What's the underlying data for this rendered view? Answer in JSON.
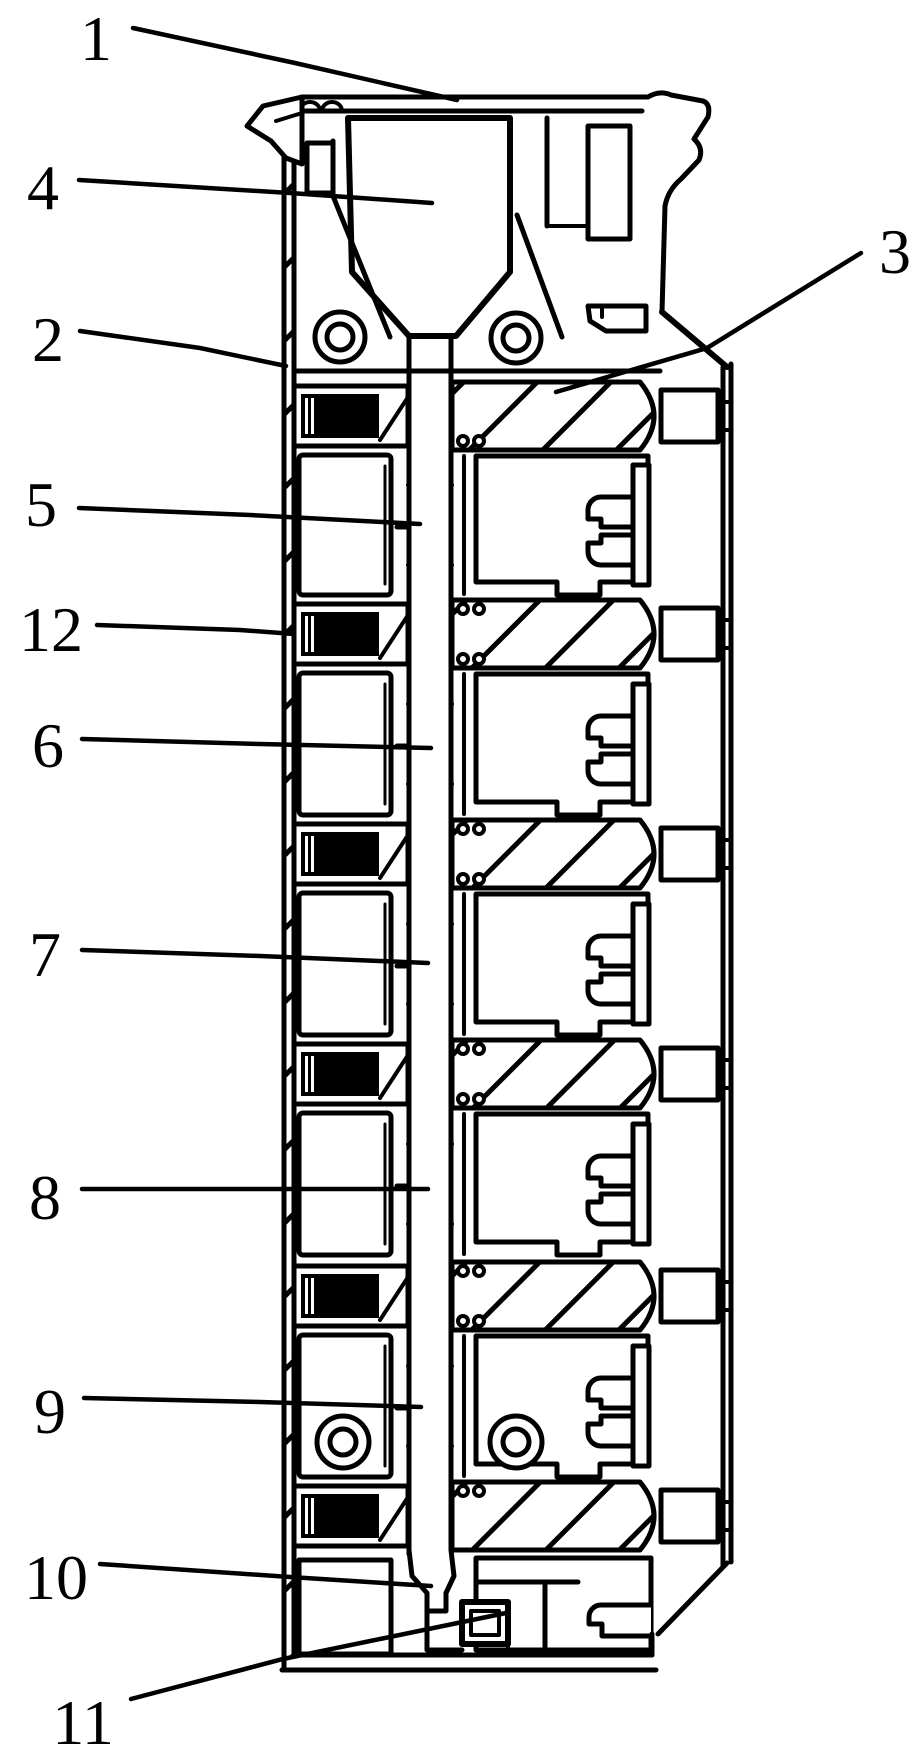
{
  "figure": {
    "description": "patent-style sectional diagram of a vertical multi-chamber connector assembly",
    "colors": {
      "ink": "#000000",
      "paper": "#ffffff"
    }
  },
  "labels": [
    {
      "text": "1",
      "x": 96,
      "y": 38,
      "leader": [
        [
          133,
          28
        ],
        [
          295,
          63
        ],
        [
          457,
          100
        ]
      ]
    },
    {
      "text": "4",
      "x": 43,
      "y": 187,
      "leader": [
        [
          79,
          180
        ],
        [
          290,
          193
        ],
        [
          432,
          203
        ]
      ]
    },
    {
      "text": "2",
      "x": 48,
      "y": 339,
      "leader": [
        [
          80,
          331
        ],
        [
          200,
          348
        ],
        [
          286,
          366
        ]
      ]
    },
    {
      "text": "3",
      "x": 895,
      "y": 251,
      "leader": [
        [
          861,
          253
        ],
        [
          707,
          348
        ],
        [
          556,
          392
        ]
      ]
    },
    {
      "text": "5",
      "x": 41,
      "y": 504,
      "leader": [
        [
          79,
          508
        ],
        [
          250,
          515
        ],
        [
          420,
          524
        ]
      ]
    },
    {
      "text": "12",
      "x": 51,
      "y": 629,
      "leader": [
        [
          97,
          625
        ],
        [
          240,
          630
        ],
        [
          294,
          634
        ]
      ]
    },
    {
      "text": "6",
      "x": 48,
      "y": 745,
      "leader": [
        [
          82,
          739
        ],
        [
          260,
          744
        ],
        [
          431,
          748
        ]
      ]
    },
    {
      "text": "7",
      "x": 45,
      "y": 954,
      "leader": [
        [
          82,
          950
        ],
        [
          260,
          956
        ],
        [
          428,
          963
        ]
      ]
    },
    {
      "text": "8",
      "x": 45,
      "y": 1197,
      "leader": [
        [
          82,
          1189
        ],
        [
          280,
          1189
        ],
        [
          428,
          1189
        ]
      ]
    },
    {
      "text": "9",
      "x": 50,
      "y": 1411,
      "leader": [
        [
          84,
          1398
        ],
        [
          260,
          1402
        ],
        [
          421,
          1407
        ]
      ]
    },
    {
      "text": "10",
      "x": 56,
      "y": 1577,
      "leader": [
        [
          100,
          1564
        ],
        [
          290,
          1577
        ],
        [
          431,
          1586
        ]
      ]
    },
    {
      "text": "11",
      "x": 83,
      "y": 1722,
      "leader": [
        [
          131,
          1699
        ],
        [
          283,
          1659
        ],
        [
          506,
          1613
        ]
      ]
    }
  ]
}
